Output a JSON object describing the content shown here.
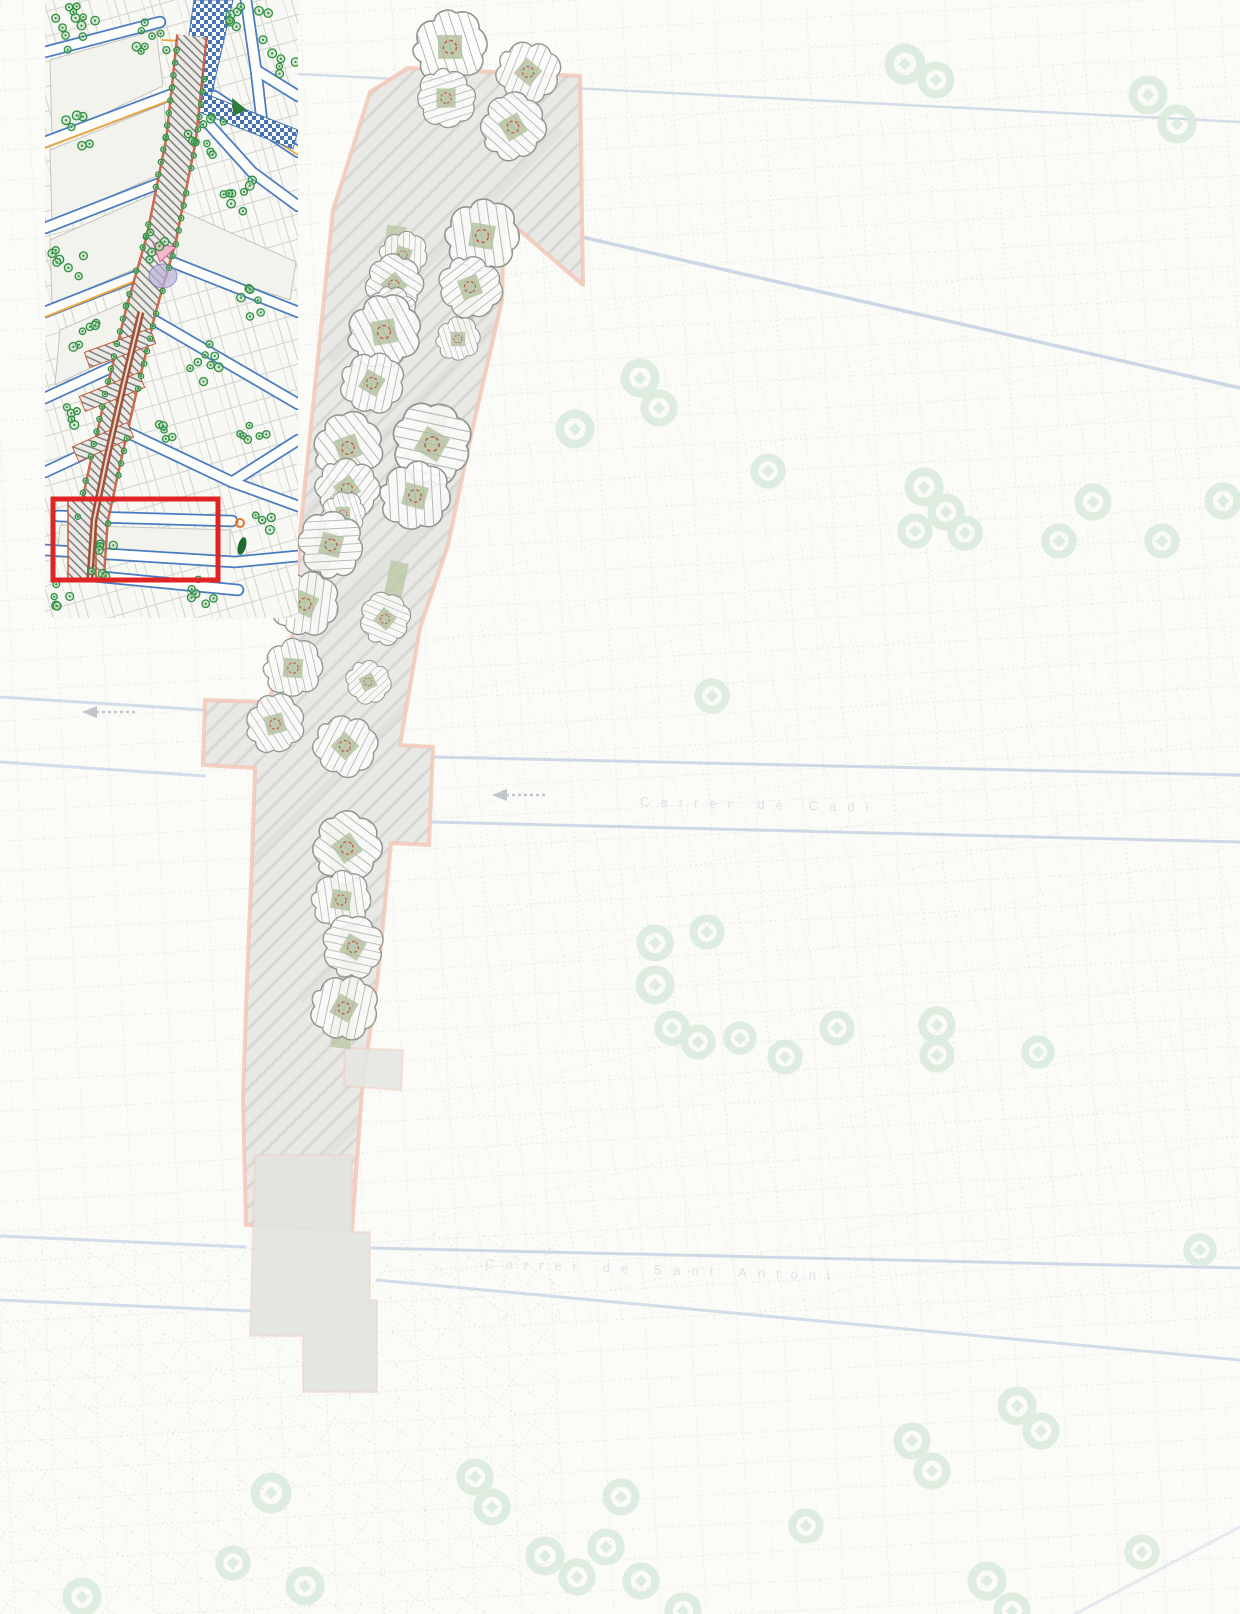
{
  "map": {
    "street_label_upper": "Carrer de Cadí",
    "street_label_lower": "Carrer de Sant Antoni",
    "colors": {
      "paper": "#fbfbf8",
      "corridor_fill": "#e6e6e3",
      "corridor_outline": "#f3c7b8",
      "corridor_hatch": "#d3d3cf",
      "planting_strip": "#b8c6a4",
      "tree_outline": "#8e938e",
      "tree_hatch": "#b2b7b1",
      "tree_center_mark": "#c4564a",
      "bg_tree_ring": "#dcebde",
      "bg_street_line": "#c2d0e2",
      "bg_parcel_line": "#d8dbd4",
      "inset_street_blue": "#4a7cc0",
      "inset_avenue_red": "#c65a3c",
      "inset_tree_green": "#2f8f43",
      "inset_canal_blue": "#3a6cb0",
      "inset_orange": "#f0a83c",
      "highlight_red": "#e02424"
    },
    "corridor_trees": [
      [
        450,
        47,
        1.0,
        0
      ],
      [
        528,
        72,
        0.85,
        40
      ],
      [
        446,
        98,
        0.8,
        90
      ],
      [
        513,
        127,
        0.9,
        -30
      ],
      [
        482,
        236,
        1.0,
        10
      ],
      [
        470,
        287,
        0.85,
        70
      ],
      [
        458,
        339,
        0.6,
        0
      ],
      [
        403,
        255,
        0.65,
        20
      ],
      [
        394,
        285,
        0.8,
        -40
      ],
      [
        392,
        310,
        0.65,
        80
      ],
      [
        384,
        332,
        1.0,
        -10
      ],
      [
        372,
        383,
        0.85,
        30
      ],
      [
        432,
        444,
        1.1,
        -60
      ],
      [
        415,
        496,
        0.95,
        15
      ],
      [
        348,
        448,
        0.95,
        -20
      ],
      [
        347,
        489,
        0.85,
        55
      ],
      [
        343,
        514,
        0.6,
        0
      ],
      [
        331,
        545,
        0.9,
        -75
      ],
      [
        305,
        604,
        0.9,
        25
      ],
      [
        385,
        619,
        0.7,
        -50
      ],
      [
        293,
        668,
        0.8,
        5
      ],
      [
        368,
        682,
        0.6,
        65
      ],
      [
        275,
        724,
        0.8,
        -15
      ],
      [
        345,
        746,
        0.85,
        45
      ],
      [
        347,
        848,
        0.95,
        -35
      ],
      [
        341,
        900,
        0.8,
        10
      ],
      [
        353,
        947,
        0.85,
        -60
      ],
      [
        344,
        1008,
        0.9,
        30
      ]
    ],
    "planting_strips": [
      [
        397,
        226,
        382,
        346,
        20
      ],
      [
        473,
        276,
        462,
        333,
        18
      ],
      [
        440,
        406,
        422,
        499,
        20
      ],
      [
        349,
        436,
        307,
        621,
        20
      ],
      [
        400,
        562,
        386,
        626,
        18
      ],
      [
        334,
        820,
        352,
        950,
        20
      ],
      [
        352,
        950,
        340,
        1048,
        20
      ]
    ],
    "bg_tree_rings": [
      [
        905,
        64,
        22
      ],
      [
        936,
        80,
        20
      ],
      [
        1148,
        95,
        21
      ],
      [
        1177,
        124,
        21
      ],
      [
        575,
        429,
        21
      ],
      [
        640,
        378,
        21
      ],
      [
        659,
        408,
        20
      ],
      [
        768,
        471,
        19
      ],
      [
        924,
        487,
        21
      ],
      [
        946,
        512,
        20
      ],
      [
        915,
        531,
        19
      ],
      [
        965,
        533,
        19
      ],
      [
        1093,
        502,
        20
      ],
      [
        1223,
        501,
        20
      ],
      [
        1059,
        541,
        19
      ],
      [
        1162,
        541,
        19
      ],
      [
        712,
        696,
        19
      ],
      [
        655,
        943,
        20
      ],
      [
        707,
        932,
        19
      ],
      [
        655,
        985,
        21
      ],
      [
        672,
        1028,
        19
      ],
      [
        698,
        1042,
        19
      ],
      [
        740,
        1038,
        18
      ],
      [
        785,
        1057,
        19
      ],
      [
        837,
        1028,
        19
      ],
      [
        937,
        1025,
        20
      ],
      [
        937,
        1055,
        19
      ],
      [
        1038,
        1052,
        18
      ],
      [
        271,
        1493,
        22
      ],
      [
        82,
        1597,
        21
      ],
      [
        305,
        1586,
        21
      ],
      [
        233,
        1563,
        19
      ],
      [
        475,
        1477,
        20
      ],
      [
        492,
        1507,
        20
      ],
      [
        545,
        1556,
        21
      ],
      [
        577,
        1577,
        20
      ],
      [
        606,
        1547,
        20
      ],
      [
        621,
        1497,
        20
      ],
      [
        641,
        1581,
        20
      ],
      [
        683,
        1611,
        20
      ],
      [
        806,
        1526,
        19
      ],
      [
        912,
        1441,
        20
      ],
      [
        932,
        1471,
        20
      ],
      [
        1017,
        1406,
        21
      ],
      [
        1041,
        1431,
        20
      ],
      [
        987,
        1581,
        21
      ],
      [
        1012,
        1611,
        20
      ],
      [
        1142,
        1552,
        19
      ],
      [
        1200,
        1250,
        18
      ]
    ],
    "inset": {
      "highlight_rect": [
        53,
        499,
        165,
        81
      ]
    }
  }
}
